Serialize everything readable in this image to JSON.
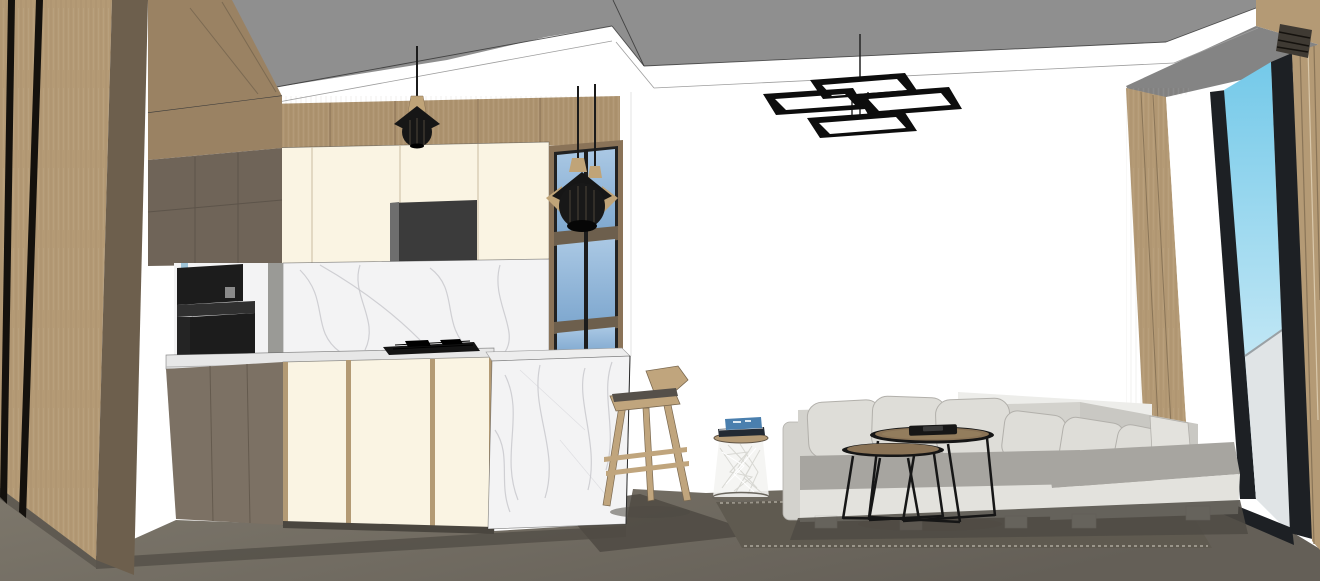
{
  "scene": {
    "description": "3D interior render (SketchUp style) of an open-plan kitchen and living room with floor-to-ceiling balcony glazing",
    "rooms": [
      "kitchen",
      "living-room",
      "balcony"
    ],
    "objects": [
      {
        "name": "wood-slat-wall",
        "color_ref": "wood_light"
      },
      {
        "name": "tall-corner-cabinets",
        "color_ref": "taupe"
      },
      {
        "name": "upper-cabinets",
        "color_ref": "cream"
      },
      {
        "name": "range-hood-niche",
        "color_ref": "niche"
      },
      {
        "name": "wood-accent-band",
        "color_ref": "wood_band"
      },
      {
        "name": "glass-display-cabinet",
        "color_ref": "glass_bottom"
      },
      {
        "name": "marble-backsplash",
        "color_ref": "marble"
      },
      {
        "name": "built-in-coffee-machine",
        "color_ref": "appliance"
      },
      {
        "name": "gas-cooktop",
        "color_ref": "cooktop"
      },
      {
        "name": "kitchen-countertop",
        "color_ref": "counter"
      },
      {
        "name": "base-cabinets",
        "color_ref": "cream"
      },
      {
        "name": "marble-waterfall-island",
        "color_ref": "marble"
      },
      {
        "name": "cage-pendant-lights",
        "color_ref": "pendant_black"
      },
      {
        "name": "rectangular-ring-chandelier",
        "color_ref": "chandelier"
      },
      {
        "name": "wooden-bar-stool",
        "color_ref": "stool_wood"
      },
      {
        "name": "wire-side-table",
        "color_ref": "wire_fill"
      },
      {
        "name": "stacked-books",
        "color_ref": "book_blue"
      },
      {
        "name": "l-shaped-sectional-sofa",
        "color_ref": "sofa_body"
      },
      {
        "name": "throw-pillows",
        "color_ref": "sofa_pillow"
      },
      {
        "name": "nesting-coffee-tables",
        "color_ref": "table_wood"
      },
      {
        "name": "serving-tray",
        "color_ref": "metal"
      },
      {
        "name": "area-rug",
        "color_ref": "rug"
      },
      {
        "name": "recessed-tray-ceiling",
        "color_ref": "ceiling_gray"
      },
      {
        "name": "sliding-glass-door",
        "color_ref": "window_frame"
      },
      {
        "name": "balcony-glass-railing",
        "color_ref": "railing"
      },
      {
        "name": "sky",
        "color_ref": "sky_top"
      },
      {
        "name": "air-vent-grille",
        "color_ref": "vent"
      },
      {
        "name": "concrete-floor",
        "color_ref": "floor_a"
      }
    ]
  },
  "colors": {
    "wall": "#ffffff",
    "ceiling_gray": "#8f8f8f",
    "ceiling_gray_dark": "#848484",
    "wood_light": "#b49a75",
    "wood_band": "#ae9470",
    "wood_mid": "#9a8263",
    "wood_dark": "#6d5f4d",
    "wood_seam": "#8d7557",
    "taupe": "#6f6458",
    "taupe_door": "#7c7164",
    "cream": "#faf4e3",
    "niche": "#3b3b3b",
    "gray_strip": "#9a9a96",
    "marble": "#f3f3f4",
    "vein": "#c6c6cb",
    "counter": "#e7e7e7",
    "island_top": "#ededed",
    "appliance": "#1c1c1c",
    "appliance2": "#303030",
    "cooktop": "#141414",
    "glass_top": "#aac8e4",
    "glass_bottom": "#7fa8cf",
    "cab_frame_wood": "#8a7358",
    "window_frame": "#1d2024",
    "pendant_black": "#161616",
    "pendant_wood": "#c0a478",
    "chandelier": "#0d0d0d",
    "sofa_body": "#d3d2cd",
    "sofa_pillow": "#deddd8",
    "sofa_pillow_line": "#b2b0ab",
    "sofa_seat": "#a7a5a0",
    "sofa_base": "#e3e2dd",
    "sofa_foot": "#e9e8e3",
    "sofa_shadow": "#4f4b44",
    "shadow_wall": "#ededea",
    "table_wood": "#8a7356",
    "table_wood_light": "#9a8463",
    "metal": "#161616",
    "stool_wood": "#c0a57d",
    "stool_seat": "#55504a",
    "wire_fill": "#f4f4f2",
    "wire_line": "#d8d8d3",
    "book_blue": "#4a7fae",
    "book_dark": "#232a33",
    "rug": "#5f5a50",
    "rug_edge": "#9a958a",
    "floor_a": "#7e786c",
    "floor_b": "#645f57",
    "shadow": "#4f4a43",
    "sky_top": "#74c9e9",
    "sky_bottom": "#eef8fc",
    "railing": "#e0e4e6",
    "railing_line": "#9aa1a5",
    "vent": "#3f3a33",
    "side_gray": "#d8d8d8"
  }
}
